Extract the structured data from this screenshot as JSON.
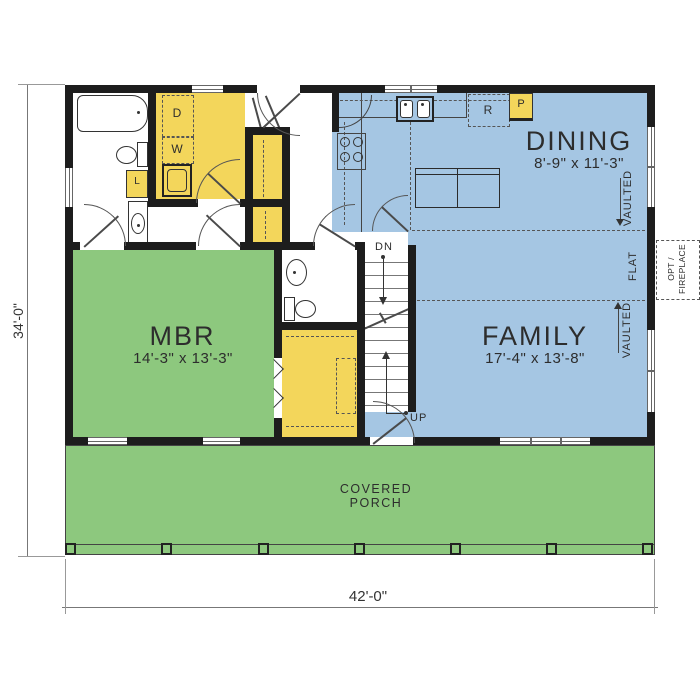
{
  "plan": {
    "dimensions": {
      "overall_depth": "34'-0\"",
      "overall_width": "42'-0\""
    },
    "rooms": {
      "dining": {
        "name": "DINING",
        "size": "8'-9\" x 11'-3\""
      },
      "family": {
        "name": "FAMILY",
        "size": "17'-4\" x 13'-8\""
      },
      "mbr": {
        "name": "MBR",
        "size": "14'-3\" x 13'-3\""
      },
      "porch": {
        "line1": "COVERED",
        "line2": "PORCH"
      }
    },
    "ceiling": {
      "vaulted": "VAULTED",
      "flat": "FLAT"
    },
    "fireplace": {
      "line1": "OPT /",
      "line2": "FIREPLACE"
    },
    "appliances": {
      "dryer": "D",
      "washer": "W",
      "linen": "L",
      "refrigerator": "R",
      "pantry": "P"
    },
    "stairs": {
      "down": "DN",
      "up": "UP"
    },
    "colors": {
      "living_blue": "#a5c6e3",
      "bedroom_green": "#8dc87e",
      "storage_yellow": "#f3d65b",
      "wall_black": "#1d1d1d"
    }
  }
}
